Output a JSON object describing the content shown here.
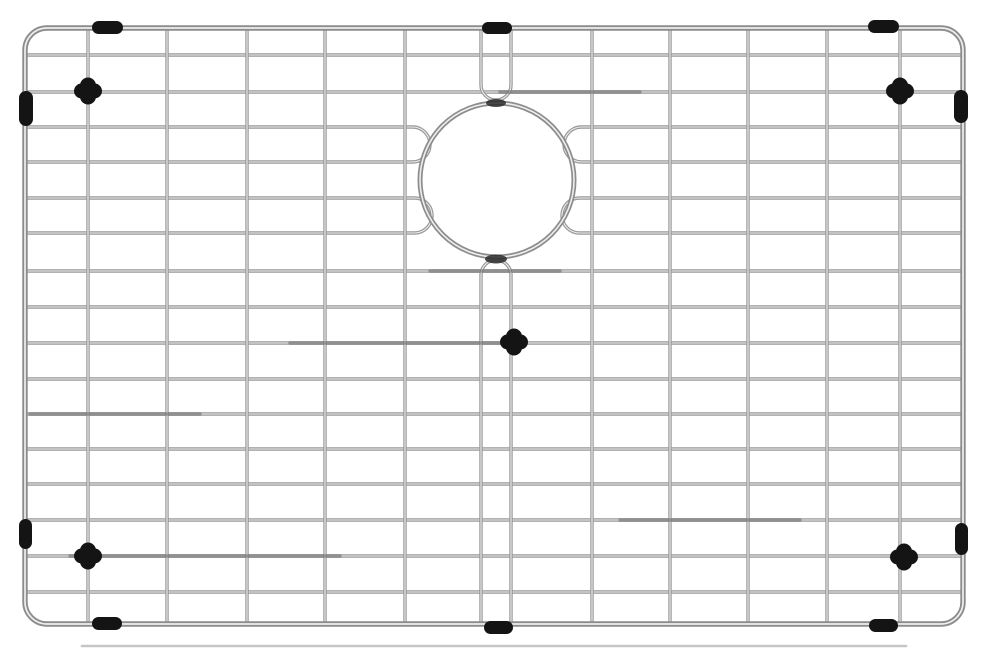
{
  "meta": {
    "description": "Stainless steel kitchen sink bottom grid with round drain opening and black rubber bumpers",
    "width": 989,
    "height": 654,
    "background": "#ffffff"
  },
  "colors": {
    "wire": "#989898",
    "wire_dark": "#5f5f5f",
    "wire_highlight": "#eeeeee",
    "frame": "#8c8c8c",
    "rubber": "#141414",
    "weld_shadow": "#2c2c2c",
    "rear_rail": "#b7b7b7"
  },
  "frame": {
    "left": 25,
    "top": 28,
    "right": 963,
    "bottom": 624,
    "corner_radius": 22,
    "thickness": 5.4
  },
  "rear_rail": {
    "y": 646,
    "x1": 82,
    "x2": 906,
    "thickness": 2.6
  },
  "wires": {
    "thickness": 3.4,
    "horizontal_full_y": [
      55,
      92,
      271,
      307,
      343,
      379,
      414,
      449,
      484,
      520,
      556,
      592
    ],
    "horizontal_hairpins": [
      {
        "y1": 127,
        "y2": 162,
        "left_bend_x": 430,
        "right_bend_x": 564
      },
      {
        "y1": 198,
        "y2": 233,
        "left_bend_x": 432,
        "right_bend_x": 562
      }
    ],
    "vertical_full_x": [
      88,
      167,
      247,
      325,
      405,
      592,
      670,
      748,
      827,
      900
    ],
    "vertical_hairpin": {
      "x1": 481,
      "x2": 511,
      "top_arc_y": 85,
      "bottom_arc_y": 275
    }
  },
  "drain_opening": {
    "cx": 497,
    "cy": 180,
    "r": 77,
    "thickness": 5
  },
  "weld_shadows": [
    {
      "cx": 496,
      "cy": 103,
      "rx": 10,
      "ry": 4
    },
    {
      "cx": 496,
      "cy": 259,
      "rx": 11,
      "ry": 4.5
    }
  ],
  "shading_segments": [
    {
      "y": 92,
      "x1": 500,
      "x2": 640
    },
    {
      "y": 271,
      "x1": 430,
      "x2": 560
    },
    {
      "y": 343,
      "x1": 290,
      "x2": 500
    },
    {
      "y": 414,
      "x1": 30,
      "x2": 200
    },
    {
      "y": 520,
      "x1": 620,
      "x2": 800
    },
    {
      "y": 556,
      "x1": 70,
      "x2": 340
    },
    {
      "y": 624,
      "x1": 95,
      "x2": 330
    },
    {
      "y": 624,
      "x1": 700,
      "x2": 880
    }
  ],
  "rubber": {
    "edge_bumpers": [
      {
        "name": "rubber-bumper-top-left",
        "x": 92,
        "y": 21,
        "w": 31,
        "h": 13
      },
      {
        "name": "rubber-bumper-top-center",
        "x": 482,
        "y": 22,
        "w": 30,
        "h": 12
      },
      {
        "name": "rubber-bumper-top-right",
        "x": 868,
        "y": 20,
        "w": 31,
        "h": 13
      },
      {
        "name": "rubber-bumper-bottom-left",
        "x": 92,
        "y": 617,
        "w": 30,
        "h": 13
      },
      {
        "name": "rubber-bumper-bottom-center",
        "x": 484,
        "y": 621,
        "w": 29,
        "h": 13
      },
      {
        "name": "rubber-bumper-bottom-right",
        "x": 869,
        "y": 619,
        "w": 29,
        "h": 13
      }
    ],
    "side_feet": [
      {
        "name": "rubber-foot-left-top",
        "x": 19,
        "y": 91,
        "w": 14,
        "h": 35
      },
      {
        "name": "rubber-foot-left-bottom",
        "x": 19,
        "y": 519,
        "w": 13,
        "h": 30
      },
      {
        "name": "rubber-foot-right-top",
        "x": 954,
        "y": 90,
        "w": 14,
        "h": 33
      },
      {
        "name": "rubber-foot-right-bottom",
        "x": 955,
        "y": 523,
        "w": 13,
        "h": 32
      }
    ],
    "wire_clips": [
      {
        "name": "rubber-clip-top-left",
        "cx": 88,
        "cy": 91
      },
      {
        "name": "rubber-clip-top-right",
        "cx": 900,
        "cy": 91
      },
      {
        "name": "rubber-clip-center",
        "cx": 514,
        "cy": 342
      },
      {
        "name": "rubber-clip-bottom-left",
        "cx": 88,
        "cy": 556
      },
      {
        "name": "rubber-clip-bottom-right",
        "cx": 904,
        "cy": 557
      }
    ],
    "clip_size": {
      "w": 28,
      "h": 15,
      "vw": 16,
      "vh": 27
    }
  }
}
